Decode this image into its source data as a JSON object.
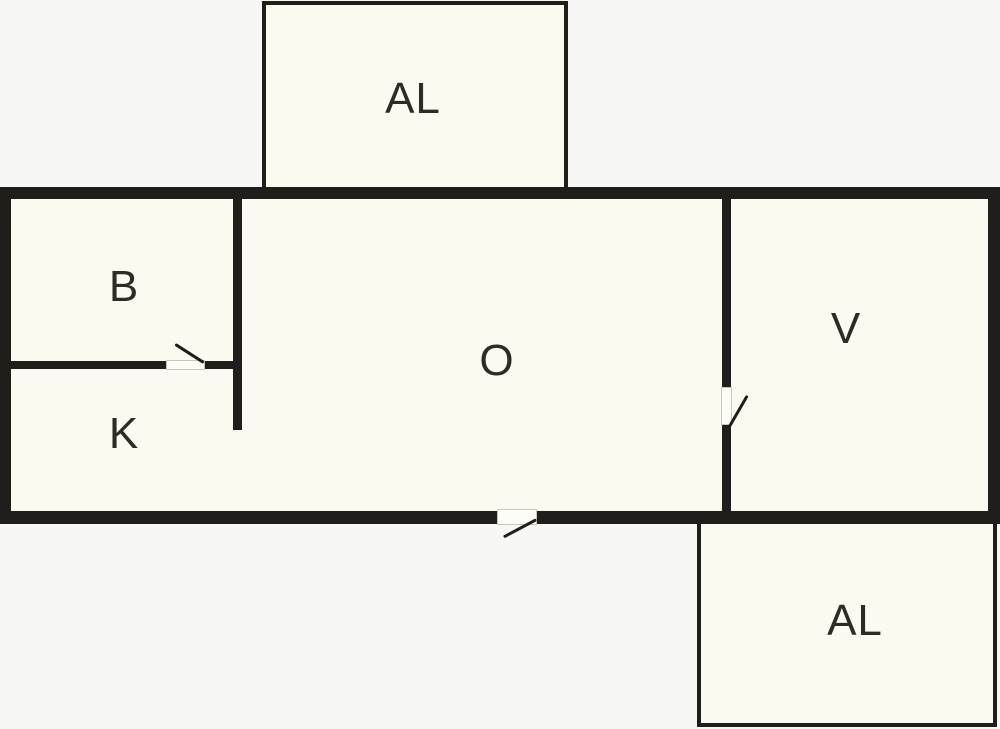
{
  "title": "Apartment floor plan",
  "colors": {
    "wall": "#211d1a",
    "room_fill": "#fbfaf1",
    "background": "#f7f7f5",
    "door_leaf": "#fdfdf8",
    "label_color": "#2e2a26"
  },
  "rooms": [
    {
      "id": "balcony-top",
      "label": "AL"
    },
    {
      "id": "room-b",
      "label": "B"
    },
    {
      "id": "room-k",
      "label": "K"
    },
    {
      "id": "room-o",
      "label": "O"
    },
    {
      "id": "room-v",
      "label": "V"
    },
    {
      "id": "balcony-bottom",
      "label": "AL"
    }
  ],
  "doors": [
    {
      "id": "door-b-k",
      "between": "B and K",
      "type": "interior swing door"
    },
    {
      "id": "door-o-v",
      "between": "O and V",
      "type": "interior swing door"
    },
    {
      "id": "door-o-exterior",
      "between": "O and outside (bottom wall)",
      "type": "exterior swing door"
    }
  ]
}
